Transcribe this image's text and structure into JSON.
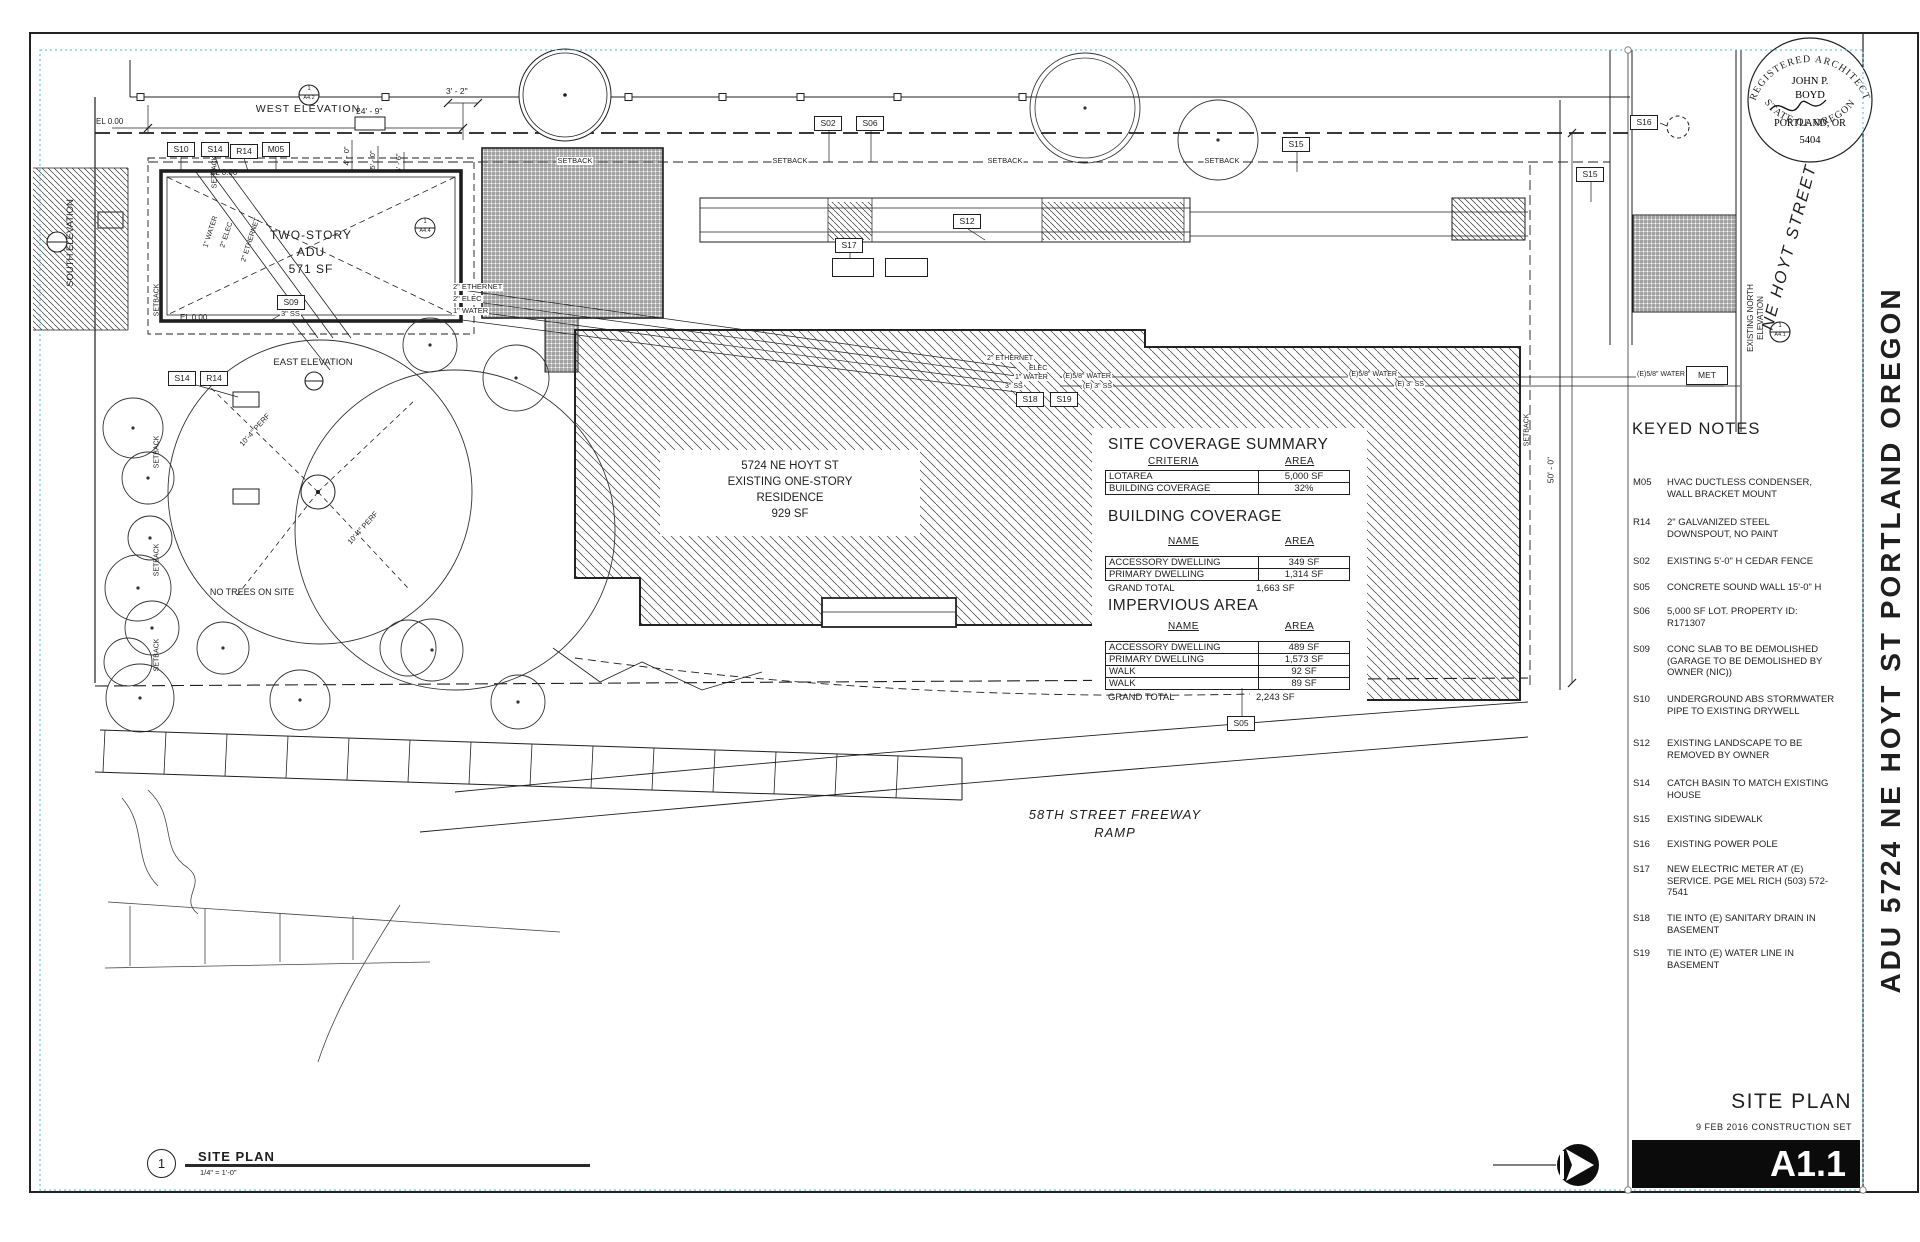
{
  "colors": {
    "ink": "#1f1f1f",
    "selection": "#45b8cc",
    "paper": "#ffffff"
  },
  "sheet": {
    "stamp": {
      "arc_top": "REGISTERED ARCHITECT",
      "name_line1": "JOHN P.",
      "name_line2": "BOYD",
      "city": "PORTLAND, OR",
      "license": "5404",
      "arc_bottom": "STATE OF OREGON"
    },
    "street_label": "NE HOYT STREET",
    "north_elevation_label_line1": "EXISTING NORTH",
    "north_elevation_label_line2": "ELEVATION",
    "project_title": "ADU 5724 NE HOYT ST PORTLAND OREGON",
    "title_block": {
      "title": "SITE PLAN",
      "date_line": "9 FEB 2016 CONSTRUCTION SET",
      "sheet_number": "A1.1"
    },
    "drawing_title": {
      "number": "1",
      "title": "SITE PLAN",
      "scale": "1/4\" = 1'-0\""
    }
  },
  "keyed_notes": {
    "heading": "KEYED NOTES",
    "items": [
      {
        "code": "M05",
        "text": "HVAC DUCTLESS CONDENSER, WALL BRACKET MOUNT"
      },
      {
        "code": "R14",
        "text": "2\" GALVANIZED STEEL DOWNSPOUT, NO PAINT"
      },
      {
        "code": "S02",
        "text": "EXISTING 5'-0\" H CEDAR FENCE"
      },
      {
        "code": "S05",
        "text": "CONCRETE SOUND WALL 15'-0\" H"
      },
      {
        "code": "S06",
        "text": "5,000 SF LOT.  PROPERTY ID: R171307"
      },
      {
        "code": "S09",
        "text": "CONC SLAB TO BE DEMOLISHED (GARAGE TO BE DEMOLISHED BY OWNER (NIC))"
      },
      {
        "code": "S10",
        "text": "UNDERGROUND ABS STORMWATER PIPE TO EXISTING DRYWELL"
      },
      {
        "code": "S12",
        "text": "EXISTING LANDSCAPE TO BE REMOVED BY OWNER"
      },
      {
        "code": "S14",
        "text": "CATCH BASIN TO MATCH EXISTING HOUSE"
      },
      {
        "code": "S15",
        "text": "EXISTING SIDEWALK"
      },
      {
        "code": "S16",
        "text": "EXISTING POWER POLE"
      },
      {
        "code": "S17",
        "text": "NEW ELECTRIC METER AT (E) SERVICE. PGE MEL RICH (503) 572-7541"
      },
      {
        "code": "S18",
        "text": "TIE INTO (E) SANITARY DRAIN IN BASEMENT"
      },
      {
        "code": "S19",
        "text": "TIE INTO (E) WATER LINE IN BASEMENT"
      }
    ]
  },
  "tables": {
    "site_coverage": {
      "heading": "SITE COVERAGE SUMMARY",
      "col1": "CRITERIA",
      "col2": "AREA",
      "rows": [
        [
          "LOTAREA",
          "5,000 SF"
        ],
        [
          "BUILDING COVERAGE",
          "32%"
        ]
      ]
    },
    "building_coverage": {
      "heading": "BUILDING COVERAGE",
      "col1": "NAME",
      "col2": "AREA",
      "rows": [
        [
          "ACCESSORY DWELLING",
          "349 SF"
        ],
        [
          "PRIMARY DWELLING",
          "1,314 SF"
        ]
      ],
      "total_label": "GRAND TOTAL",
      "total_value": "1,663 SF"
    },
    "impervious": {
      "heading": "IMPERVIOUS AREA",
      "col1": "NAME",
      "col2": "AREA",
      "rows": [
        [
          "ACCESSORY DWELLING",
          "489 SF"
        ],
        [
          "PRIMARY DWELLING",
          "1,573 SF"
        ],
        [
          "WALK",
          "92 SF"
        ],
        [
          "WALK",
          "89 SF"
        ]
      ],
      "total_label": "GRAND TOTAL",
      "total_value": "2,243 SF"
    }
  },
  "tags": [
    "S10",
    "S14",
    "R14",
    "M05",
    "S09",
    "S02",
    "S06",
    "S12",
    "S17",
    "S18",
    "S19",
    "S15",
    "S16",
    "S05"
  ],
  "plan": {
    "west_elevation": "WEST ELEVATION",
    "east_elevation": "EAST ELEVATION",
    "south_elevation": "SOUTH ELEVATION",
    "el_zero": "EL 0.00",
    "setback": "SETBACK",
    "dim_24_9": "24' - 9\"",
    "dim_3_2": "3' - 2\"",
    "dim_4_0": "4' - 0\"",
    "dim_5_0": "5' - 0\"",
    "dim_5_6": "5' - 6\"",
    "dim_50_0": "50' - 0\"",
    "adu_line1": "TWO-STORY",
    "adu_line2": "ADU",
    "adu_line3": "571 SF",
    "res_line1": "5724 NE HOYT ST",
    "res_line2": "EXISTING ONE-STORY",
    "res_line3": "RESIDENCE",
    "res_line4": "929 SF",
    "no_trees": "NO TREES ON SITE",
    "freeway_line1": "58TH STREET FREEWAY",
    "freeway_line2": "RAMP",
    "ethernet": "2\" ETHERNET",
    "elec2": "2\" ELEC",
    "elec": "ELEC",
    "water1": "1\" WATER",
    "ss3": "3\" SS",
    "e_water": "(E)5/8\" WATER",
    "e_ss": "(E) 3\" SS",
    "perf": "10'-4\" PERF",
    "met": "MET",
    "mk_1": "1",
    "mk_a42": "A4.2",
    "mk_a44": "A4.4",
    "mk_a41": "A4.1"
  }
}
